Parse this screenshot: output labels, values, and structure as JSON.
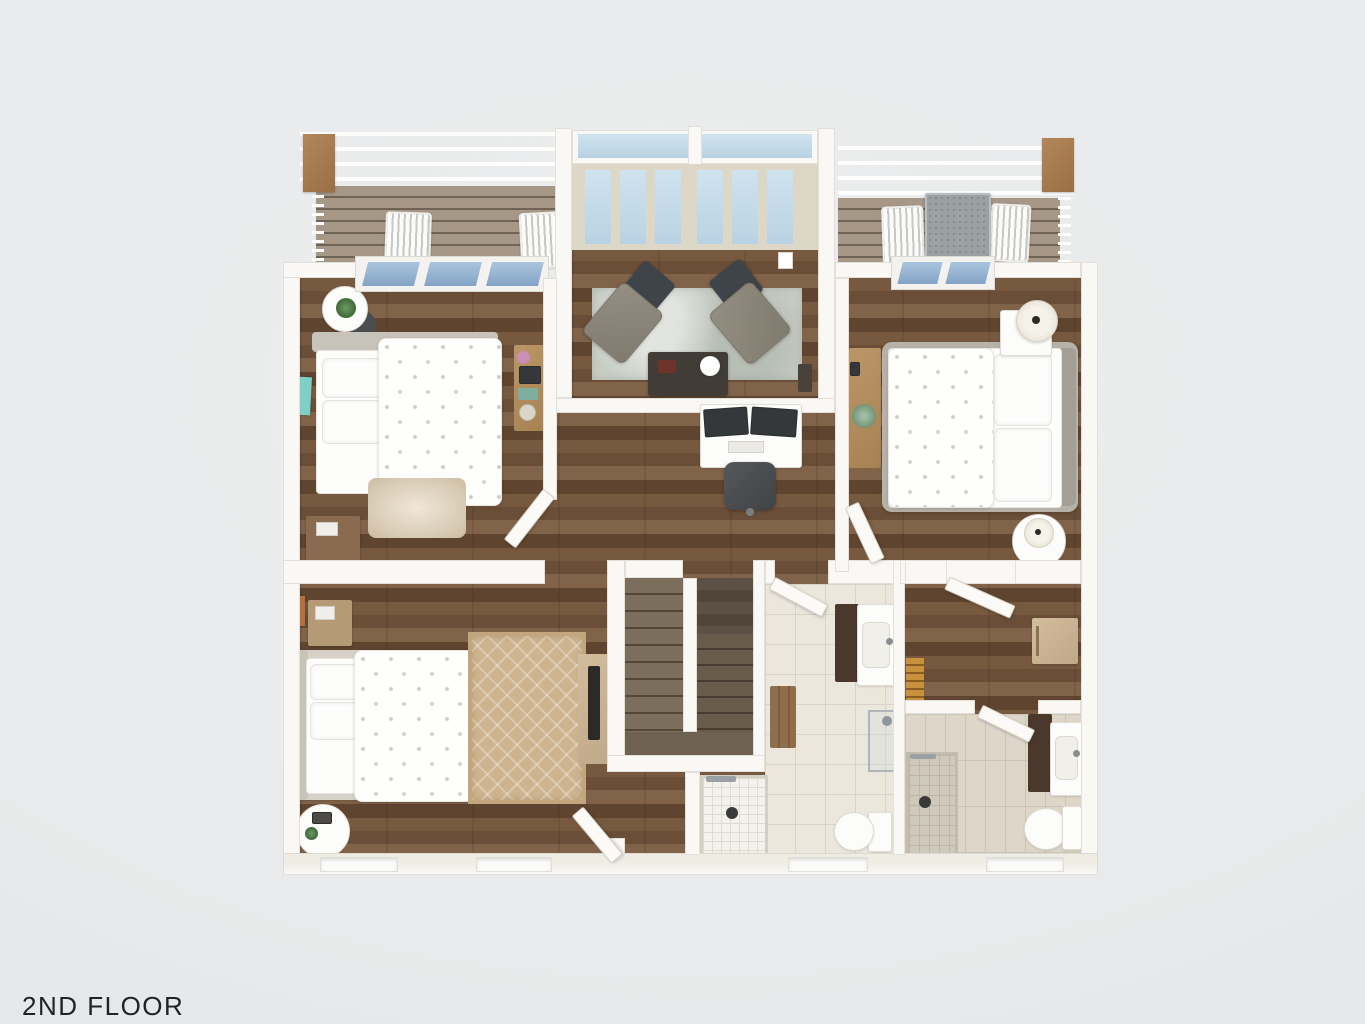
{
  "title": {
    "label": "2ND FLOOR"
  },
  "palette": {
    "background": "#e8eaeb",
    "wall": "#f9f8f5",
    "wood_floor": "#6f553e",
    "deck_wood": "#a39483",
    "bath_tile": "#ebe7dc",
    "glass": "#9fbcd8",
    "rug_gray": "#c9cec5",
    "rug_tan": "#cdb48e",
    "rug_shag": "#e2d8c8",
    "upholstery_gray": "#8d887b",
    "ottoman_charcoal": "#3e444a",
    "vanity_wood": "#4a382c",
    "light_wood": "#c9b697",
    "post_wood": "#a87c4f"
  },
  "rooms": {
    "balcony_left": {
      "name": "balcony-left",
      "furniture": [
        "outdoor-chair",
        "outdoor-chair",
        "wood-post",
        "railing"
      ]
    },
    "sitting_room": {
      "name": "sitting-room",
      "furniture": [
        "lounge-chair",
        "lounge-chair",
        "ottoman",
        "ottoman",
        "coffee-table",
        "flower-vase",
        "area-rug",
        "window-wall"
      ]
    },
    "balcony_right": {
      "name": "balcony-right",
      "furniture": [
        "outdoor-table",
        "outdoor-chair",
        "outdoor-chair",
        "wood-post",
        "railing"
      ]
    },
    "bedroom_left": {
      "name": "bedroom-left",
      "furniture": [
        "double-bed",
        "round-side-table",
        "potted-plant",
        "stool",
        "desk",
        "shag-rug",
        "dresser",
        "wall-art",
        "glass-sliding-door"
      ]
    },
    "bedroom_right": {
      "name": "bedroom-right",
      "furniture": [
        "double-bed",
        "nightstand",
        "table-lamp",
        "round-side-table",
        "table-lamp",
        "console-table",
        "potted-plant",
        "glass-sliding-door"
      ]
    },
    "hallway": {
      "name": "hallway",
      "furniture": [
        "computer-desk",
        "monitor",
        "monitor",
        "office-chair"
      ]
    },
    "bedroom_bottom_left": {
      "name": "bedroom-bottom-left",
      "furniture": [
        "double-bed",
        "patterned-rug",
        "media-console",
        "tv",
        "dresser",
        "round-side-table",
        "wall-art"
      ]
    },
    "staircase": {
      "name": "staircase",
      "furniture": [
        "upper-flight",
        "lower-flight",
        "landing"
      ]
    },
    "bathroom_center": {
      "name": "bathroom-center",
      "furniture": [
        "vanity-sink",
        "wood-bench",
        "walk-in-shower",
        "glass-shower-panel",
        "toilet"
      ]
    },
    "closet_room": {
      "name": "closet-room",
      "furniture": [
        "cabinet",
        "attic-ladder"
      ]
    },
    "bathroom_right": {
      "name": "bathroom-right",
      "furniture": [
        "vanity-sink",
        "walk-in-shower",
        "toilet"
      ]
    }
  }
}
